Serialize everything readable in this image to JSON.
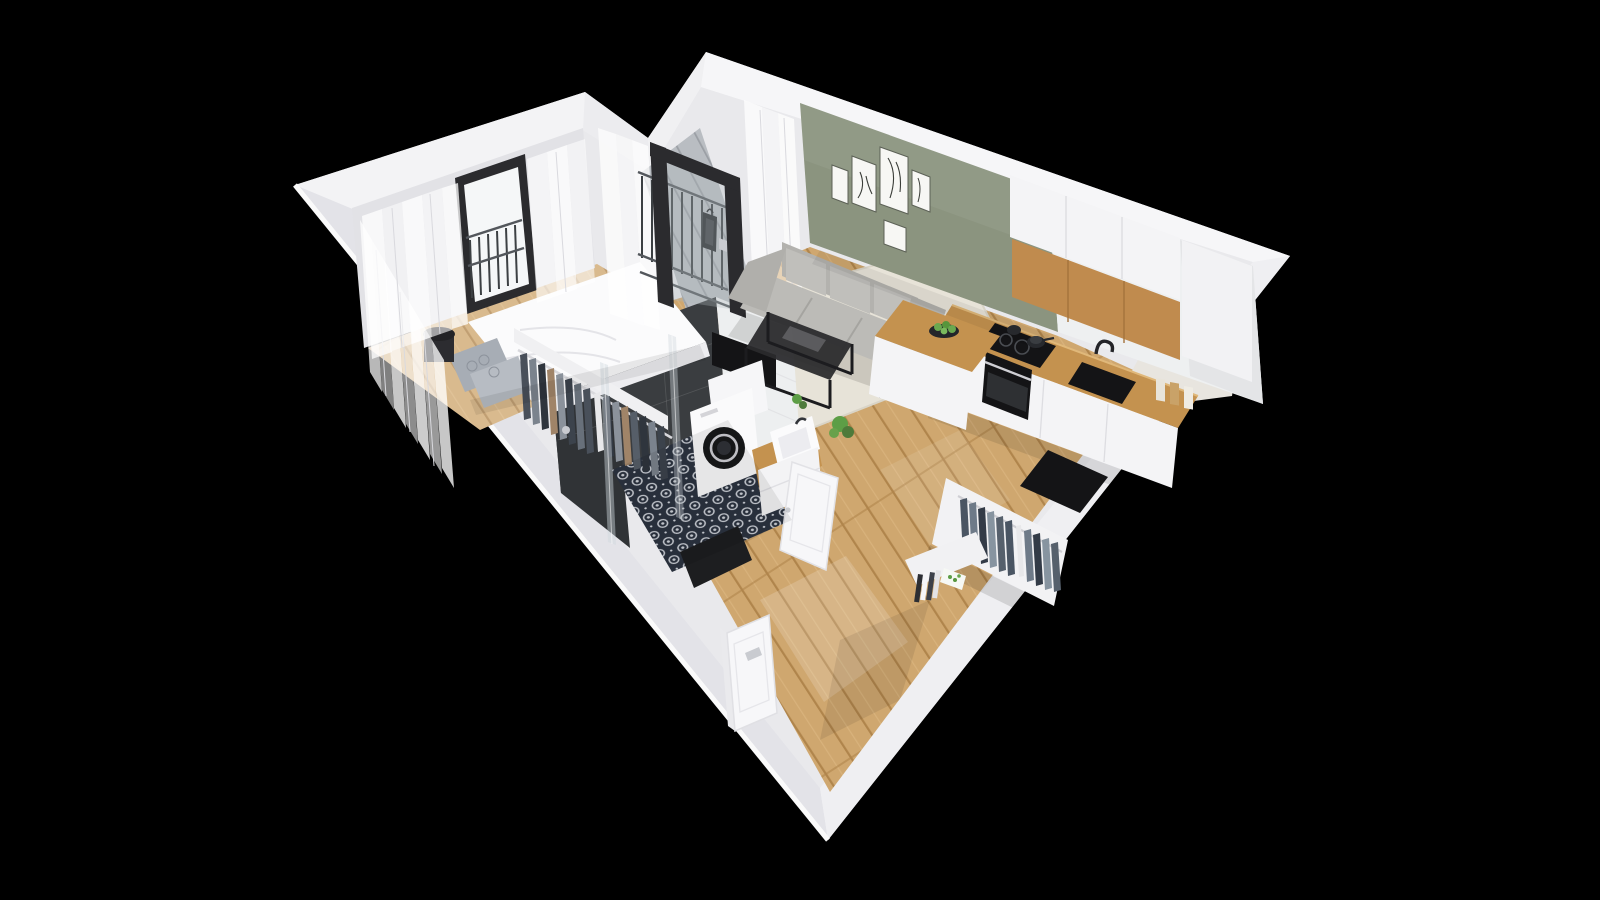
{
  "scene": {
    "type": "isometric-apartment-cutaway-render",
    "background": "#000000",
    "palette": {
      "wall": "#f1f1f4",
      "wall_band_bright": "#f6f6f8",
      "wall_band_front": "#e3e3e8",
      "wall_inner": "#e9e9ec",
      "wall_face_shaded": "#e2e2e6",
      "green_wall": "#8b947f",
      "white_wall": "#eef0f1",
      "wood": "#cfa76f",
      "wood_dark": "#b0854c",
      "wood_light": "#e6c48e",
      "bedroom_wood_tint": "#ffffff",
      "balcony_floor": "#b9bdc2",
      "counter_wood": "#c4924f",
      "cabinet_white": "#f4f4f6",
      "cabinet_wood_front": "#c08b4e",
      "dark_tile": "#3a3d40",
      "dark_tile2": "#303336",
      "bath_navy": "#2c3340",
      "bath_motif": "#cfd3da",
      "rug": "#e7e3d8",
      "sofa": "#b3b2ae",
      "sofa_cushion": "#c0bfbb",
      "appliance_black": "#141416",
      "frame_black": "#2b2b2e",
      "glass": "#aeb6ba",
      "clothes_navy": "#333a44",
      "clothes_grey": "#7b838d",
      "clothes_tan": "#a08468",
      "plant_green": "#5d9e46",
      "apple_green": "#6aa84f",
      "metal_silver": "#c9cbd0"
    },
    "rooms": [
      {
        "id": "bedroom",
        "name": "bedroom",
        "furniture": [
          "double-bed",
          "grey-patterned-pillows",
          "black-side-table",
          "sheer-curtains",
          "french-window-with-railing",
          "open-wardrobe-with-clothes"
        ]
      },
      {
        "id": "loggia",
        "name": "balcony-loggia",
        "furniture": [
          "black-framed-glass-door",
          "metal-railing",
          "lantern",
          "grey-plank-floor"
        ]
      },
      {
        "id": "living-room",
        "name": "living-room",
        "furniture": [
          "grey-three-seat-sofa",
          "black-metal-coffee-table",
          "cream-rug",
          "gallery-wall-five-frames",
          "tv-panel",
          "potted-plants",
          "grey-shell-chair"
        ]
      },
      {
        "id": "kitchen",
        "name": "kitchen",
        "furniture": [
          "white-upper-cabinets",
          "wood-front-cabinets",
          "tall-cabinet",
          "wood-countertop",
          "induction-cooktop-with-pots",
          "built-in-oven",
          "black-sink-with-faucet",
          "peninsula-with-fruit-bowl",
          "storage-jars"
        ]
      },
      {
        "id": "bathroom",
        "name": "bathroom",
        "furniture": [
          "walk-in-shower-glass",
          "dark-wall-tiles",
          "patterned-mosaic-floor",
          "washing-machine",
          "vanity-with-basin",
          "white-door",
          "dark-doormat"
        ]
      },
      {
        "id": "hallway",
        "name": "hallway",
        "furniture": [
          "entrance-door",
          "open-closet-with-clothes",
          "black-wall-niche",
          "book-stack",
          "oak-plank-floor"
        ]
      }
    ]
  }
}
